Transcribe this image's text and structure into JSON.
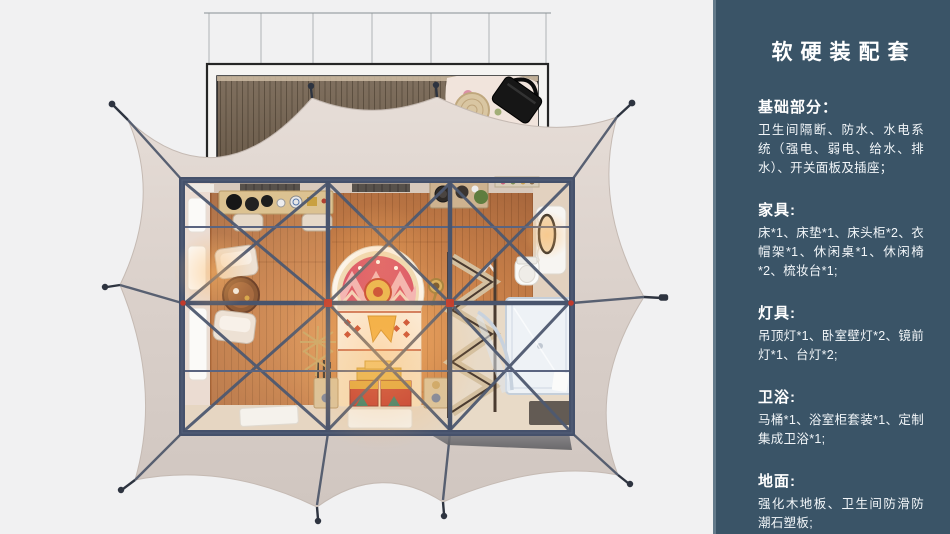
{
  "panel": {
    "title": "软硬装配套",
    "sections": [
      {
        "heading": "基础部分：",
        "body": "卫生间隔断、防水、水电系统（强电、弱电、给水、排水）、开关面板及插座；"
      },
      {
        "heading": "家具:",
        "body": "床*1、床垫*1、床头柜*2、衣帽架*1、休闲桌*1、休闲椅*2、梳妆台*1;"
      },
      {
        "heading": "灯具:",
        "body": "吊顶灯*1、卧室壁灯*2、镜前灯*1、台灯*2;"
      },
      {
        "heading": "卫浴:",
        "body": "马桶*1、浴室柜套装*1、定制集成卫浴*1;"
      },
      {
        "heading": "地面:",
        "body": "强化木地板、卫生间防滑防潮石塑板;"
      }
    ]
  },
  "colors": {
    "page_bg": "#F1F1F2",
    "panel_bg": "#3A5467",
    "panel_text": "#FFFFFF",
    "tent_fabric": "#D9CFC9",
    "frame_beam": "#49546C",
    "connector_red": "#C13A2C",
    "wood_floor": "#C07A48",
    "deck_wood": "#74655A",
    "bathroom_glass": "#EEF2F6"
  }
}
